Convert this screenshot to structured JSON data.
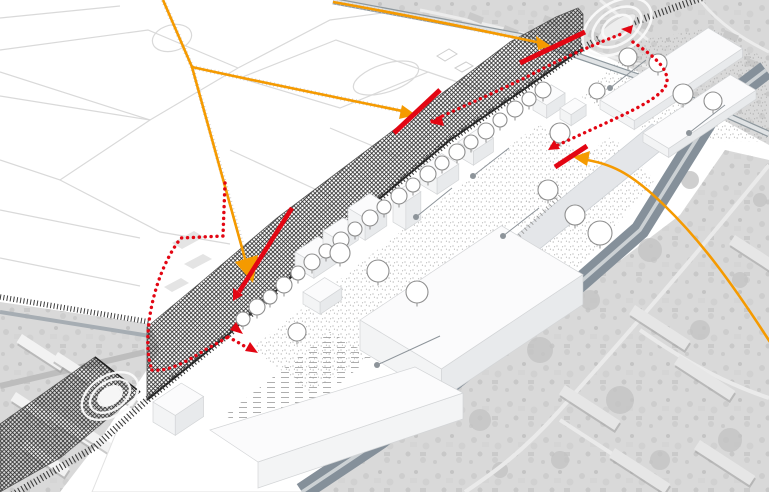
{
  "diagram": {
    "kind": "axonometric-urban-circulation-diagram",
    "colors": {
      "route_orange": "#f59a00",
      "access_red": "#e30613",
      "rail_dark": "#3c3c3c",
      "wall_ink": "#2e2e2e",
      "road_gray": "#85909a",
      "road_stripe": "#ccd1d4",
      "minor_road": "#a6adb3",
      "aerial_base": "#d9d9d9",
      "aerial_blob": "#c3c3c3",
      "stipple_dot": "#a8a8a8",
      "tree_stroke": "#8f8f8f",
      "park_line": "#d9d9d9",
      "leader_gray": "#8d949a",
      "building_top": "#fbfbfc",
      "building_front": "#f3f4f5",
      "building_side": "#e8eaec",
      "building_edge": "#d3d5d7",
      "ring_white": "#fafafa"
    },
    "legend_semantics": [
      {
        "id": "orange-route",
        "icon": "arrow-line-icon",
        "color_role": "route_orange"
      },
      {
        "id": "red-dotted-connection",
        "icon": "dotted-arrow-icon",
        "color_role": "access_red"
      },
      {
        "id": "red-opening-bar",
        "icon": "bar-icon",
        "color_role": "access_red"
      },
      {
        "id": "station-rings",
        "icon": "concentric-rings-icon",
        "count": 2
      },
      {
        "id": "rail-wall",
        "icon": "crosshatch-band-icon",
        "color_role": "wall_ink"
      },
      {
        "id": "railway-ties",
        "icon": "ladder-track-icon",
        "color_role": "rail_dark"
      },
      {
        "id": "proposed-buildings",
        "icon": "white-volume-icon"
      },
      {
        "id": "tree-row",
        "icon": "tree-icon"
      },
      {
        "id": "stippled-public-realm",
        "icon": "stipple-icon"
      },
      {
        "id": "aerial-context",
        "icon": "aerial-photo-icon"
      }
    ]
  }
}
